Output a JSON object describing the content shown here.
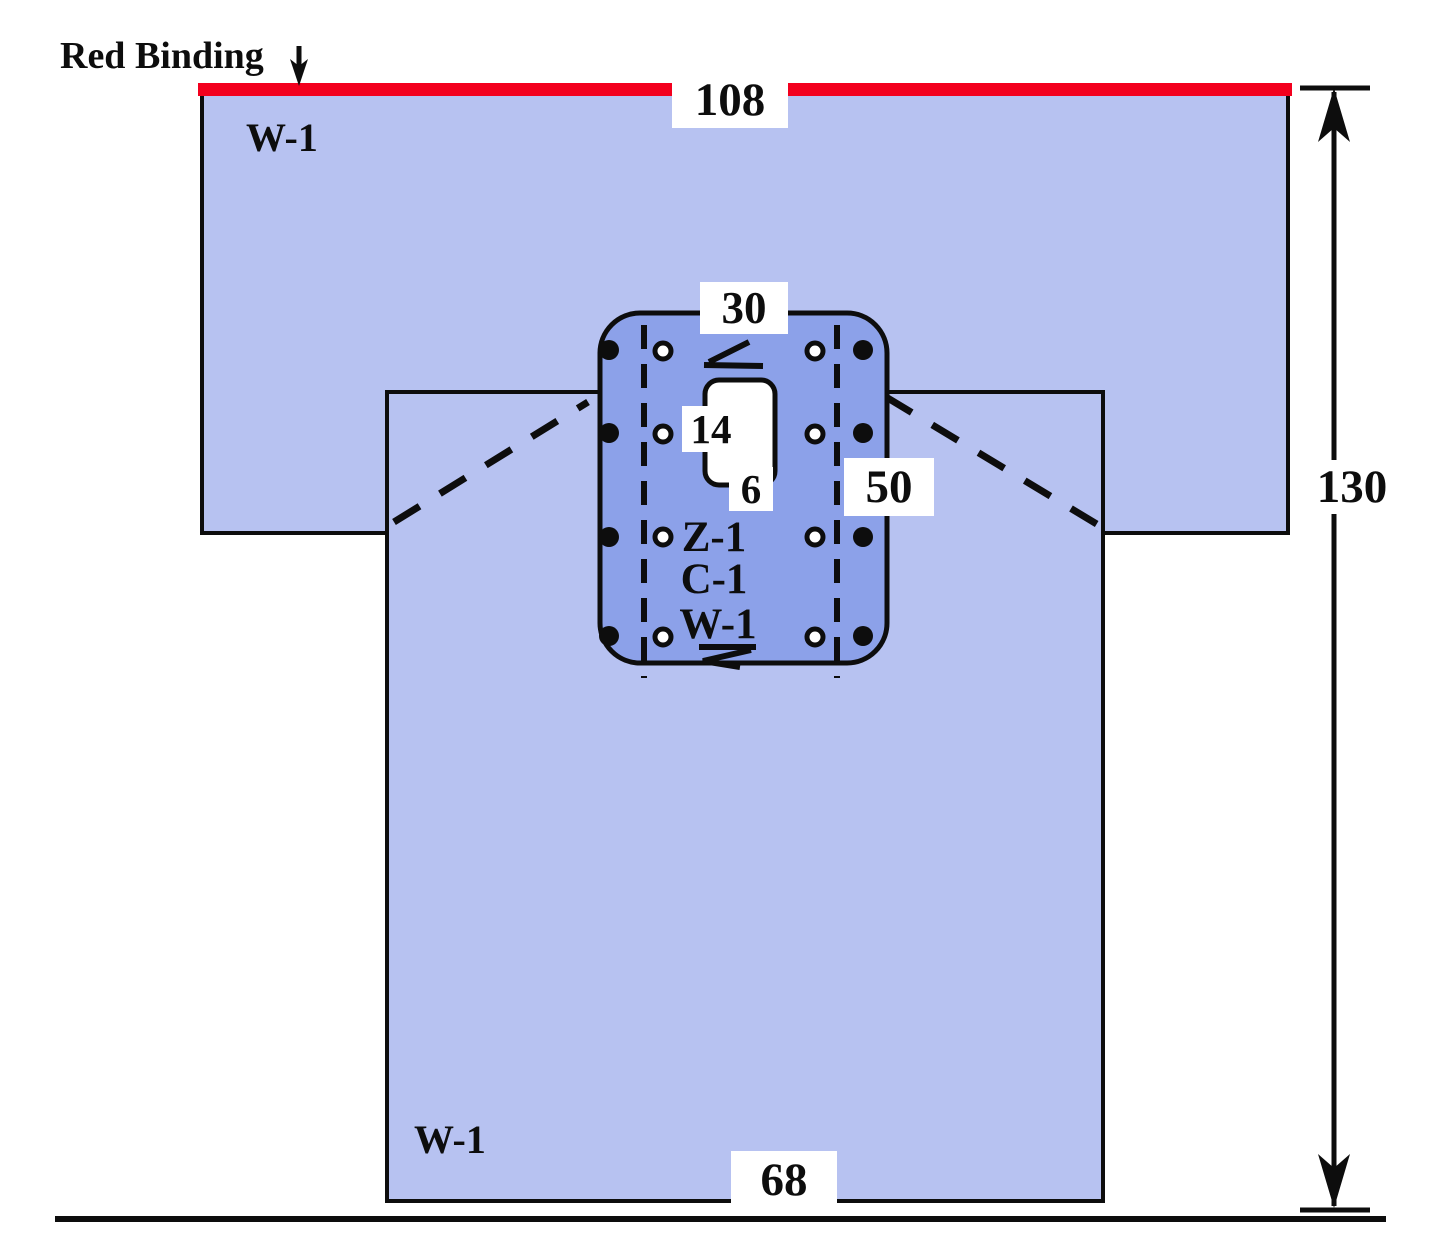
{
  "diagram": {
    "title": "Surgical drape specification drawing",
    "red_binding": {
      "label": "Red Binding"
    },
    "dimensions": {
      "top_width": "108",
      "overall_height": "130",
      "bottom_width": "68",
      "panel_width": "30",
      "panel_height": "50",
      "fenestration_length": "14",
      "fenestration_width": "6"
    },
    "materials": {
      "body_top": "W-1",
      "body_bottom": "W-1",
      "panel_layers": [
        "Z-1",
        "C-1",
        "W-1"
      ]
    },
    "colors": {
      "body_fill": "#B7C2F1",
      "panel_fill": "#8CA1E9",
      "binding_red": "#F3001E",
      "line": "#0D0D0D"
    }
  }
}
